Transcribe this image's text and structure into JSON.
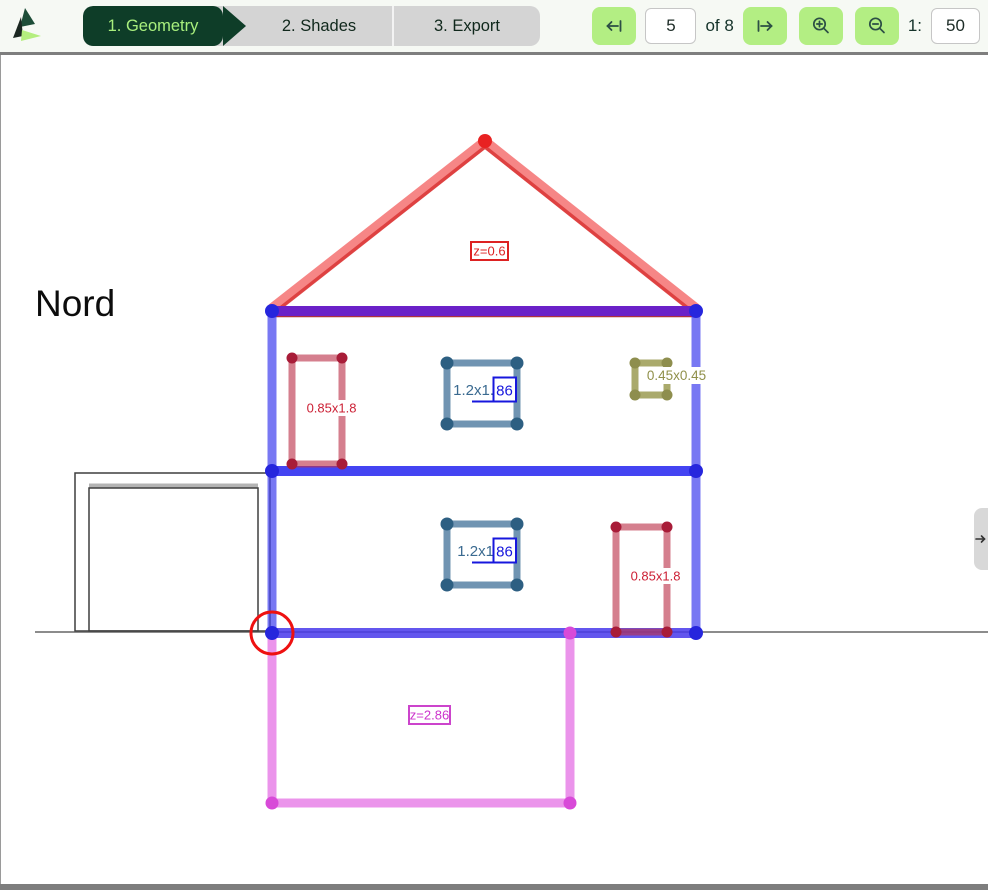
{
  "header": {
    "logo": "triangle-house-logo",
    "tabs": [
      {
        "label": "1. Geometry",
        "active": true
      },
      {
        "label": "2. Shades",
        "active": false
      },
      {
        "label": "3. Export",
        "active": false
      }
    ],
    "pager": {
      "prev_icon": "arrow-left-to-bar",
      "page": "5",
      "of_label": "of 8",
      "next_icon": "arrow-right-to-bar",
      "zoom_in_icon": "magnifier-plus",
      "zoom_out_icon": "magnifier-minus",
      "scale_prefix": "1:",
      "scale": "50"
    }
  },
  "canvas": {
    "orientation_label": "Nord",
    "roof_label": "z=0.6",
    "basement_label": "z=2.86",
    "windows": {
      "upper_left_red": {
        "label": "0.85x1.8"
      },
      "upper_center_blue": {
        "label": "1.2x1.",
        "edit_value": "86"
      },
      "upper_right_olive": {
        "label": "0.45x0.45"
      },
      "lower_center_blue": {
        "label": "1.2x1",
        "edit_value": "86"
      },
      "lower_right_red": {
        "label": "0.85x1.8"
      }
    },
    "page_indicator": "5 of 8",
    "scale_indicator": "1:50"
  },
  "side_panel_toggle": {
    "icon": "arrow-right"
  },
  "colors": {
    "tab_active_bg": "#0e3d28",
    "tab_active_text": "#a8ef7d",
    "tab_strip_bg": "#d4d4d4",
    "button_green": "#b3ee83",
    "roof_red": "#f36464",
    "ceiling_purple": "#6b21c8",
    "wall_blue": "#4444ee",
    "basement_magenta": "#e470e4",
    "window_red": "#bb3049",
    "window_steelblue": "#48769c",
    "window_olive": "#9e9e58",
    "edit_blue": "#1717dd",
    "highlight_red": "#ee1111"
  }
}
